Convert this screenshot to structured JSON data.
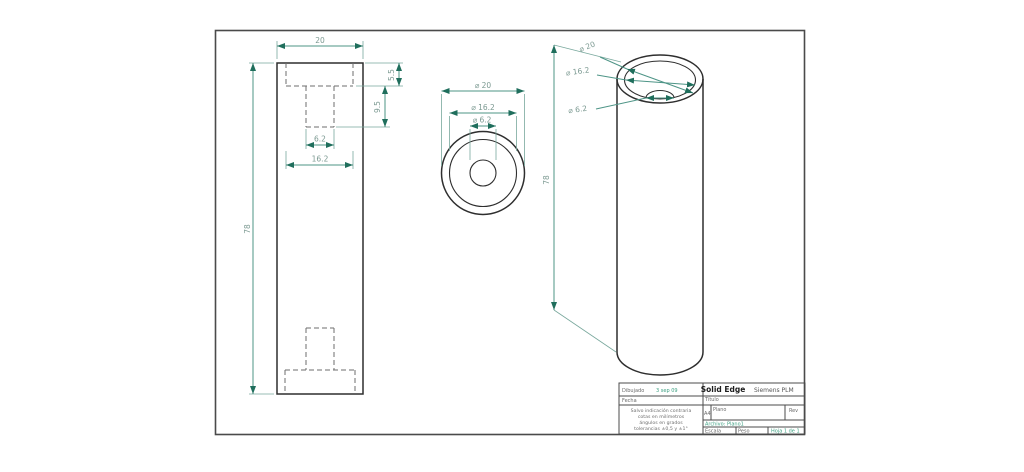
{
  "sheet": {
    "description": "Solid Edge 2D drawing sheet of a counterbored cylinder, three views"
  },
  "dimensions": {
    "front": {
      "width": "20",
      "total_height": "78",
      "cb_depth": "5.5",
      "hole_depth": "9.5",
      "hole_width": "6.2",
      "cb_width": "16.2"
    },
    "top": {
      "outer_dia": "⌀ 20",
      "cb_dia": "⌀ 16.2",
      "hole_dia": "⌀ 6.2"
    },
    "iso": {
      "outer_dia": "⌀ 20",
      "cb_dia": "⌀ 16.2",
      "hole_dia": "⌀ 6.2",
      "height": "78"
    }
  },
  "title_block": {
    "drawn_label": "Dibujado",
    "drawn_value": "3 sep 09",
    "date_label": "Fecha",
    "app_name": "Solid Edge",
    "vendor": "Siemens PLM",
    "title_label": "Título",
    "sheet_size": "A4",
    "plan_label": "Plano",
    "rev_label": "Rev",
    "file_label": "Archivo: Plano1",
    "scale_label": "Escala",
    "weight_label": "Peso",
    "sheet_label": "Hoja 1 de 1",
    "tolerance_lines": [
      "Salvo indicación contraria",
      "cotas en milímetros",
      "ángulos en grados",
      "tolerancias ±0,5 y ±1°"
    ]
  },
  "colors": {
    "dimension_line": "#4d9486",
    "dimension_arrow": "#1f6e5c",
    "geometry": "#2e2e2e",
    "highlight_green": "#3fa183",
    "frame": "#4a4a4a"
  }
}
